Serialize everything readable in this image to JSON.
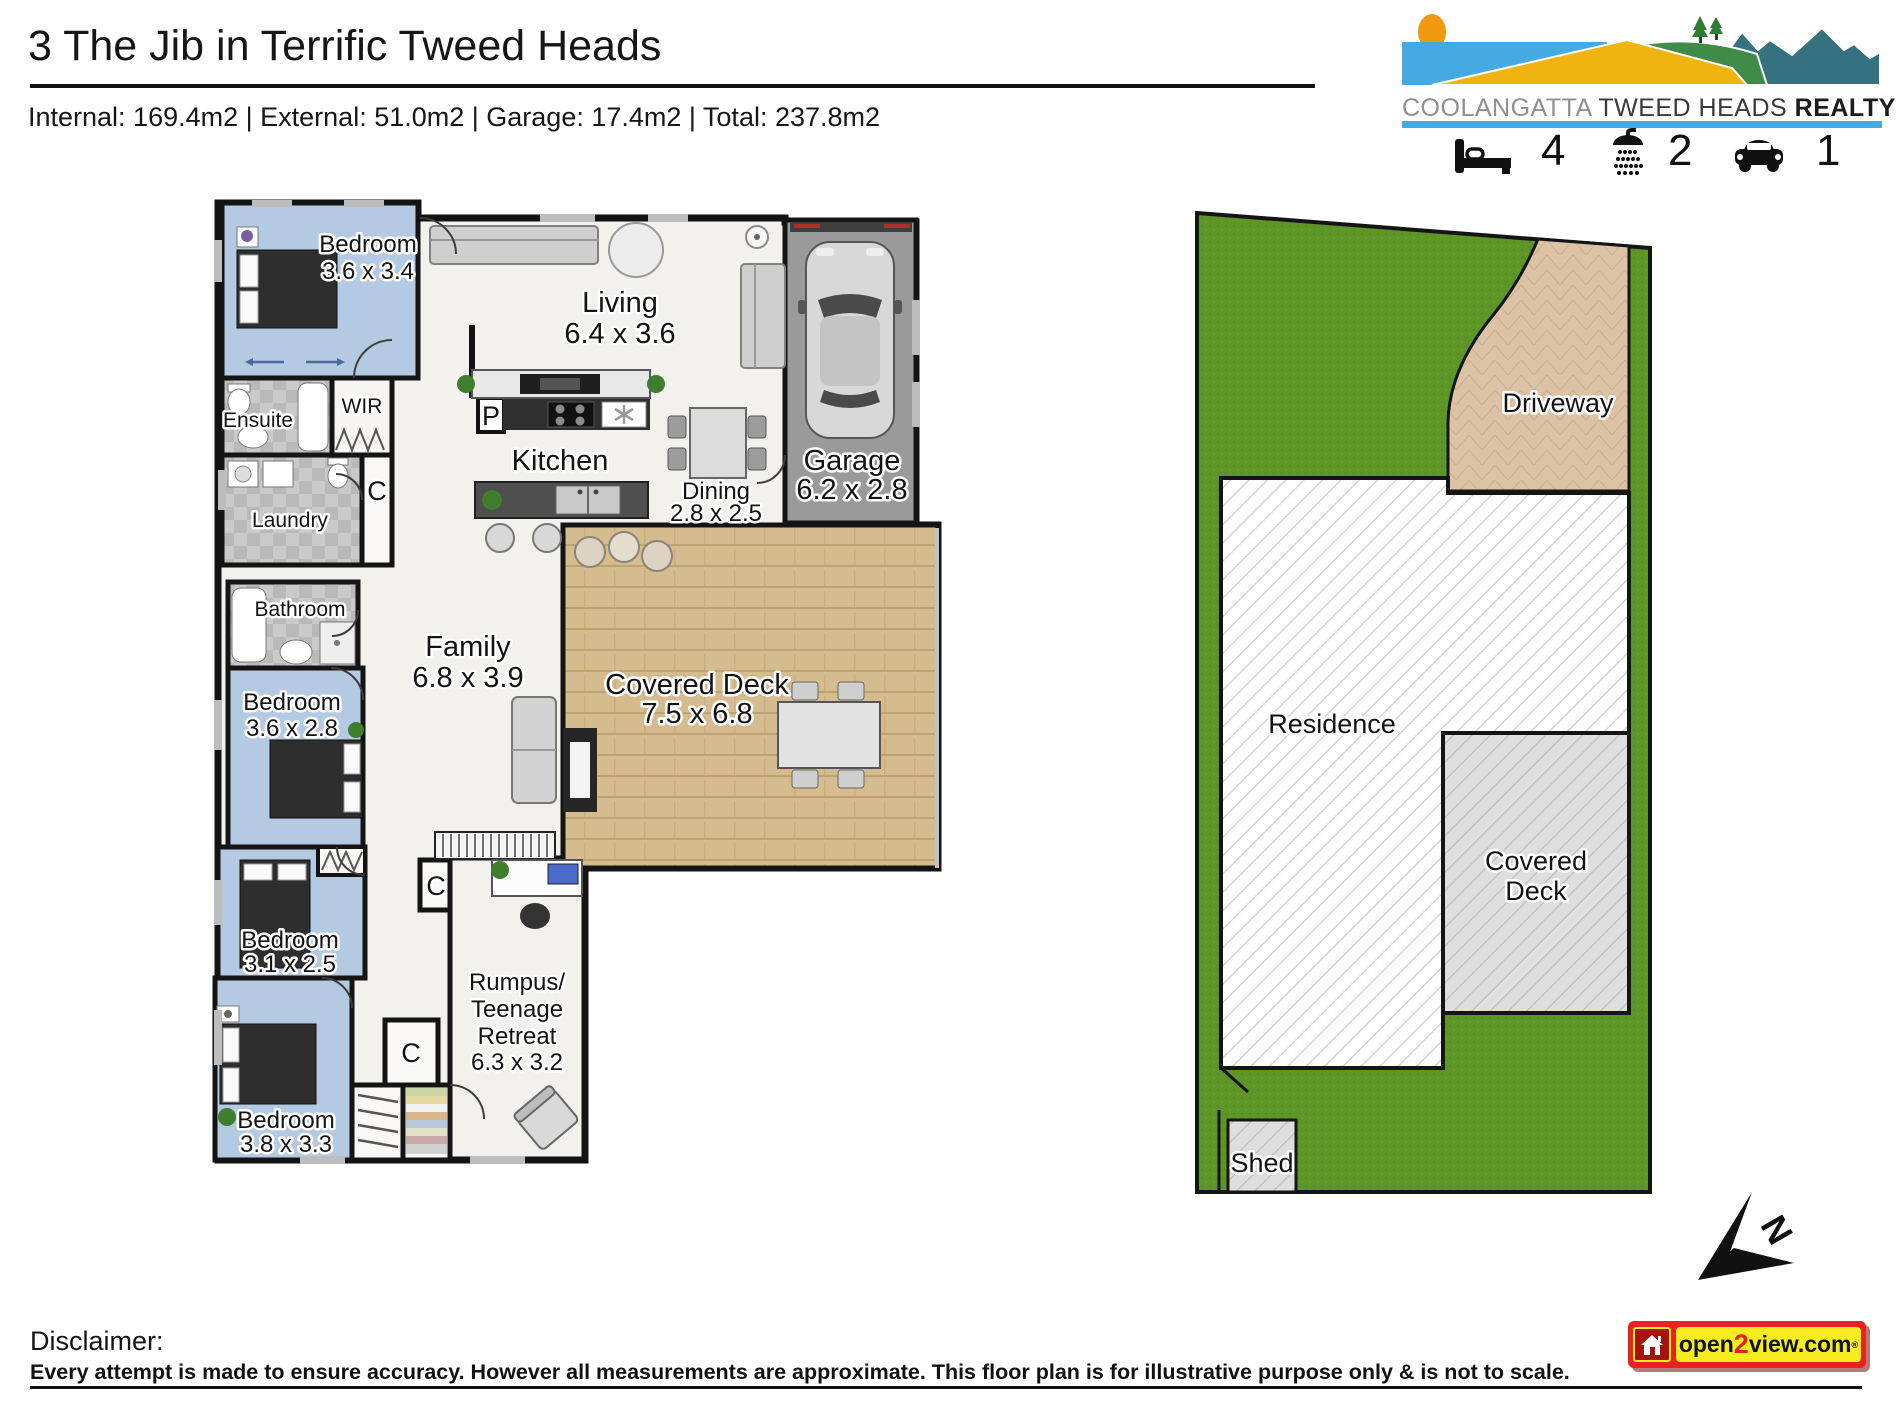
{
  "header": {
    "title": "3 The Jib in Terrific Tweed Heads",
    "measurements": "Internal: 169.4m2 | External: 51.0m2 | Garage: 17.4m2 | Total: 237.8m2"
  },
  "brand": {
    "word1": "COOLANGATTA",
    "word2": "TWEED HEADS",
    "word3": "REALTY",
    "beds": "4",
    "baths": "2",
    "cars": "1",
    "accent_blue": "#45aae1"
  },
  "floor_plan": {
    "bedroom1": {
      "label": "Bedroom",
      "dims": "3.6 x 3.4"
    },
    "ensuite": {
      "label": "Ensuite"
    },
    "wir": {
      "label": "WIR"
    },
    "laundry": {
      "label": "Laundry"
    },
    "closet1": {
      "label": "C"
    },
    "closet2": {
      "label": "C"
    },
    "closet3": {
      "label": "C"
    },
    "pantry": {
      "label": "P"
    },
    "living": {
      "label": "Living",
      "dims": "6.4 x 3.6"
    },
    "kitchen": {
      "label": "Kitchen"
    },
    "dining": {
      "label": "Dining",
      "dims": "2.8 x 2.5"
    },
    "garage": {
      "label": "Garage",
      "dims": "6.2 x 2.8"
    },
    "family": {
      "label": "Family",
      "dims": "6.8 x 3.9"
    },
    "bathroom": {
      "label": "Bathroom"
    },
    "bedroom2": {
      "label": "Bedroom",
      "dims": "3.6 x 2.8"
    },
    "bedroom3": {
      "label": "Bedroom",
      "dims": "3.1 x 2.5"
    },
    "bedroom4": {
      "label": "Bedroom",
      "dims": "3.8 x 3.3"
    },
    "deck": {
      "label": "Covered Deck",
      "dims": "7.5 x 6.8"
    },
    "rumpus": {
      "line1": "Rumpus/",
      "line2": "Teenage",
      "line3": "Retreat",
      "dims": "6.3 x 3.2"
    }
  },
  "site_plan": {
    "driveway": "Driveway",
    "residence": "Residence",
    "deck_line1": "Covered",
    "deck_line2": "Deck",
    "shed": "Shed"
  },
  "compass": {
    "north": "N"
  },
  "footer": {
    "heading": "Disclaimer:",
    "text": "Every attempt is made to ensure accuracy. However all measurements are approximate. This floor plan is for illustrative purpose only & is not to scale.",
    "logo_open": "open",
    "logo_two": "2",
    "logo_view": "view.com",
    "logo_reg": "®"
  },
  "colors": {
    "bedroom_blue": "#b4c9e2",
    "wet_area_gray": "#c9c9c9",
    "garage_gray": "#9a9a9a",
    "deck_wood": "#d5bc8e",
    "lawn_green": "#5d9627",
    "driveway_tan": "#dcc3a6",
    "brand_blue": "#45aae1",
    "logo_red": "#e8221c",
    "logo_yellow": "#f6ec20"
  }
}
